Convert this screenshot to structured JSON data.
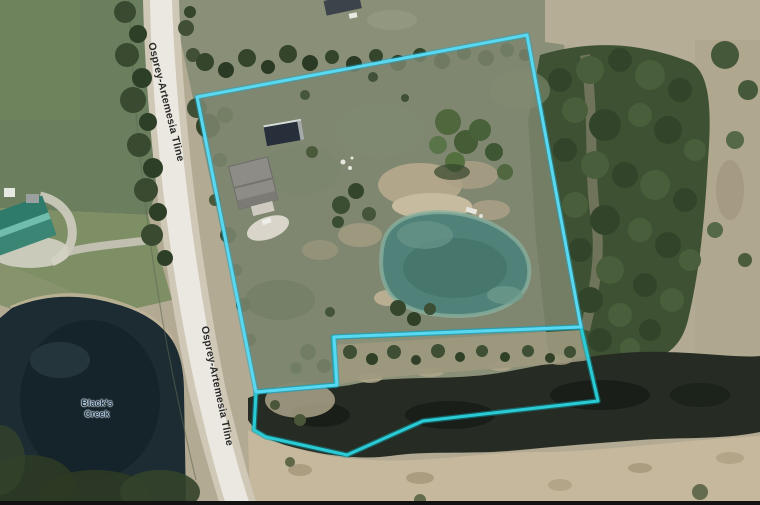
{
  "map": {
    "view": "aerial-imagery-with-parcel-boundaries",
    "road_labels": [
      {
        "text": "Osprey-Artemesia Tline"
      },
      {
        "text": "Osprey-Artemesia Tline"
      }
    ],
    "water_body_label": "Black's Creek",
    "colors": {
      "parcel_outline": "#58d9f1",
      "creek_parcel_outline": "#2acbd4",
      "road_surface": "#ebe8e1",
      "field_green": "#6b7e5d",
      "forest_green": "#3e5233",
      "dark_pond": "#1d2c33",
      "inner_pond": "#50827a",
      "creek_water": "#262c23",
      "scrub_tan": "#b3aa93"
    }
  }
}
